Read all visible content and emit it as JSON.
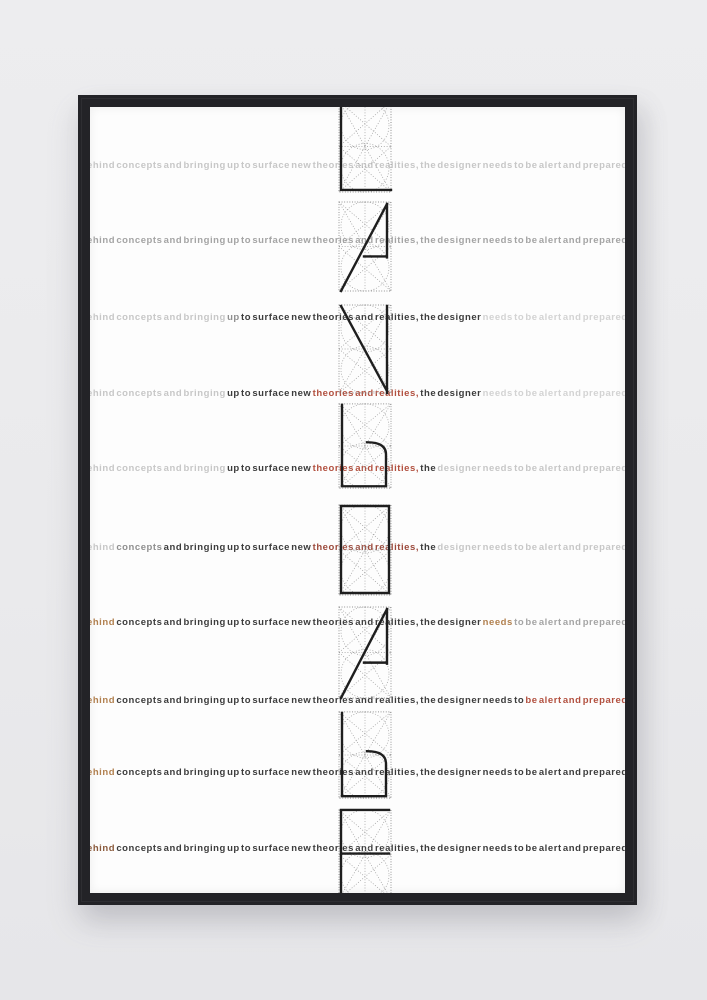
{
  "scene": {
    "description": "Photograph of a black-framed typographic art print hanging on a light gray wall",
    "wall_color": "#eaeaec",
    "frame_color": "#232327",
    "poster_color": "#fdfdfd"
  },
  "poster": {
    "sentence": "ehind concepts and bringing up to surface new theories and realities, the designer needs to be alert and prepared",
    "words": [
      "ehind",
      "concepts",
      "and",
      "bringing",
      "up",
      "to",
      "surface",
      "new",
      "theories",
      "and",
      "realities,",
      "the",
      "designer",
      "needs",
      "to",
      "be",
      "alert",
      "and",
      "prepared"
    ],
    "palette": {
      "light": "#c7c7c7",
      "mid": "#a4a4a4",
      "semi": "#8f8f8f",
      "dark": "#3c3c3c",
      "faint": "#d3d3d3",
      "red": "#b2503f",
      "redish": "#9c4a3c",
      "tan": "#b1804f",
      "darktan": "#8a5a3c"
    },
    "rows": [
      {
        "name": "row-1",
        "colors": [
          "light",
          "light",
          "light",
          "light",
          "light",
          "light",
          "light",
          "light",
          "light",
          "light",
          "light",
          "light",
          "light",
          "light",
          "light",
          "light",
          "light",
          "light",
          "light"
        ]
      },
      {
        "name": "row-2",
        "colors": [
          "mid",
          "mid",
          "mid",
          "mid",
          "mid",
          "mid",
          "mid",
          "mid",
          "mid",
          "mid",
          "mid",
          "mid",
          "mid",
          "mid",
          "mid",
          "mid",
          "mid",
          "mid",
          "mid"
        ]
      },
      {
        "name": "row-3",
        "colors": [
          "light",
          "light",
          "light",
          "light",
          "semi",
          "dark",
          "dark",
          "dark",
          "dark",
          "dark",
          "dark",
          "dark",
          "dark",
          "faint",
          "faint",
          "faint",
          "faint",
          "faint",
          "faint"
        ]
      },
      {
        "name": "row-4",
        "colors": [
          "light",
          "light",
          "light",
          "light",
          "dark",
          "dark",
          "dark",
          "dark",
          "red",
          "red",
          "red",
          "dark",
          "dark",
          "faint",
          "faint",
          "faint",
          "faint",
          "faint",
          "faint"
        ]
      },
      {
        "name": "row-5",
        "colors": [
          "light",
          "light",
          "light",
          "light",
          "dark",
          "dark",
          "dark",
          "dark",
          "red",
          "red",
          "red",
          "dark",
          "light",
          "light",
          "light",
          "light",
          "light",
          "light",
          "light"
        ]
      },
      {
        "name": "row-6",
        "colors": [
          "light",
          "semi",
          "dark",
          "dark",
          "dark",
          "dark",
          "dark",
          "dark",
          "redish",
          "redish",
          "redish",
          "dark",
          "light",
          "light",
          "light",
          "light",
          "light",
          "light",
          "light"
        ]
      },
      {
        "name": "row-7",
        "colors": [
          "tan",
          "dark",
          "dark",
          "dark",
          "dark",
          "dark",
          "dark",
          "dark",
          "dark",
          "dark",
          "dark",
          "dark",
          "dark",
          "tan",
          "mid",
          "mid",
          "mid",
          "mid",
          "mid"
        ]
      },
      {
        "name": "row-8",
        "colors": [
          "tan",
          "dark",
          "dark",
          "dark",
          "dark",
          "dark",
          "dark",
          "dark",
          "dark",
          "dark",
          "dark",
          "dark",
          "dark",
          "dark",
          "dark",
          "red",
          "red",
          "red",
          "red"
        ]
      },
      {
        "name": "row-9",
        "colors": [
          "tan",
          "dark",
          "dark",
          "dark",
          "dark",
          "dark",
          "dark",
          "dark",
          "dark",
          "dark",
          "dark",
          "dark",
          "dark",
          "dark",
          "dark",
          "dark",
          "dark",
          "dark",
          "dark"
        ]
      },
      {
        "name": "row-10",
        "colors": [
          "darktan",
          "dark",
          "dark",
          "dark",
          "dark",
          "dark",
          "dark",
          "dark",
          "dark",
          "dark",
          "dark",
          "dark",
          "dark",
          "dark",
          "dark",
          "dark",
          "dark",
          "dark",
          "dark"
        ]
      }
    ],
    "glyphs": [
      {
        "name": "letterform-construction-1",
        "form": "L"
      },
      {
        "name": "letterform-construction-2",
        "form": "A"
      },
      {
        "name": "letterform-construction-3",
        "form": "N"
      },
      {
        "name": "letterform-construction-4",
        "form": "b"
      },
      {
        "name": "letterform-construction-5",
        "form": "rect"
      },
      {
        "name": "letterform-construction-6",
        "form": "A"
      },
      {
        "name": "letterform-construction-7",
        "form": "b"
      },
      {
        "name": "letterform-construction-8",
        "form": "F"
      }
    ]
  }
}
